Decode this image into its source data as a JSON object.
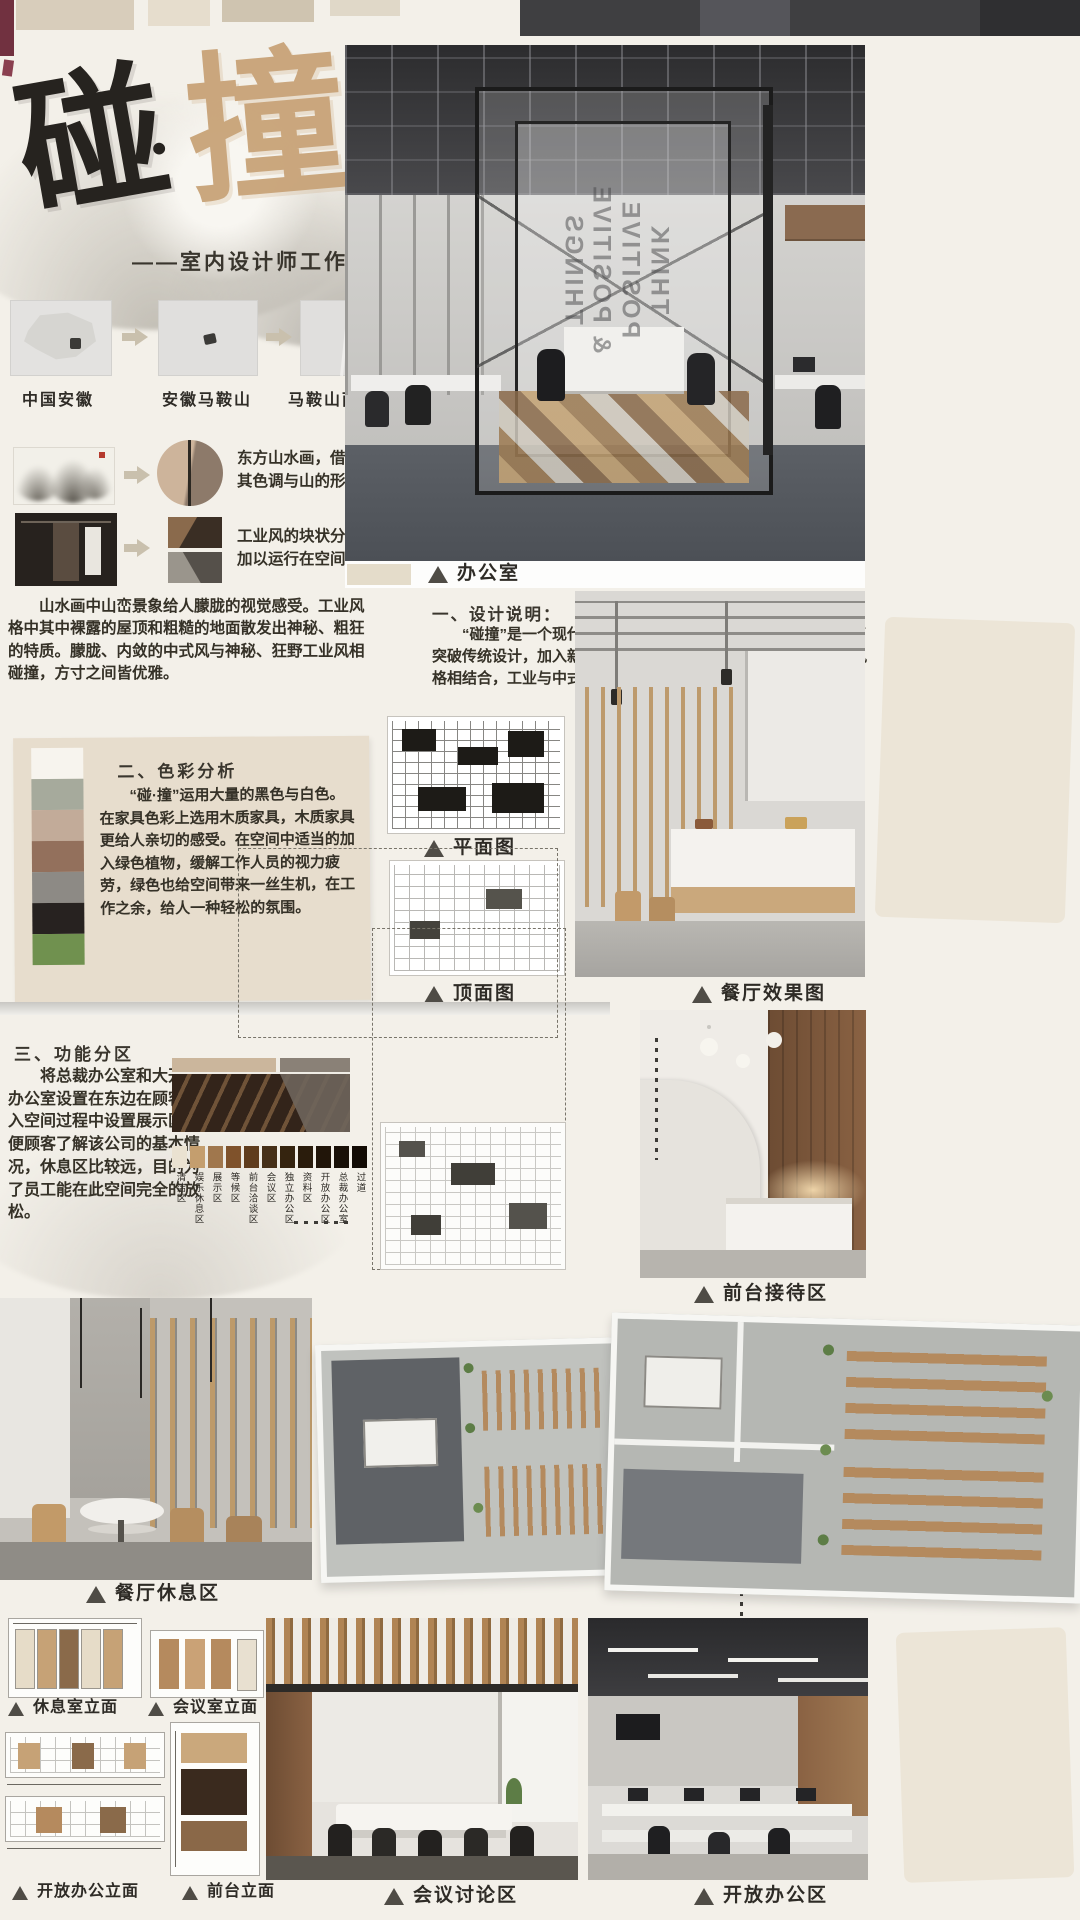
{
  "header": {
    "title_char_1": "碰",
    "title_dot": "·",
    "title_char_2": "撞",
    "subtitle": "——室内设计师工作室"
  },
  "location_flow": {
    "maps": [
      {
        "label": "中国安徽"
      },
      {
        "label": "安徽马鞍山"
      },
      {
        "label": "马鞍山雨山"
      }
    ]
  },
  "inspiration": {
    "row1_text": "东方山水画，借鉴其色调与山的形式",
    "row2_text": "工业风的块状分割加以运行在空间中",
    "summary": "山水画中山峦景象给人朦胧的视觉感受。工业风格中其中裸露的屋顶和粗糙的地面散发出神秘、粗狂的特质。朦胧、内敛的中式风与神秘、狂野工业风相碰撞，方寸之间皆优雅。"
  },
  "design_note": {
    "heading": "一、设计说明：",
    "body": "“碰撞”是一个现代办公空间，主要从事于室内设计行业。为了突破传统设计，加入新颖的设计元素，该设计将工业风与新中式风格相结合，工业与中式相碰撞，使空间更年轻化。"
  },
  "color_analysis": {
    "heading": "二、色彩分析",
    "body": "“碰·撞”运用大量的黑色与白色。在家具色彩上选用木质家具，木质家具更给人亲切的感受。在空间中适当的加入绿色植物，缓解工作人员的视力疲劳，绿色也给空间带来一丝生机，在工作之余，给人一种轻松的氛围。",
    "swatches": [
      "#f7f4ee",
      "#a6aa9c",
      "#c2ab99",
      "#93705c",
      "#8d8a85",
      "#272220",
      "#70914f"
    ]
  },
  "zoning": {
    "heading": "三、功能分区",
    "body": "将总裁办公室和大开放办公室设置在东边在顾客进入空间过程中设置展示区方便顾客了解该公司的基本情况，休息区比较远，目的为了员工能在此空间完全的放松。",
    "legend": [
      {
        "label": "清洁区",
        "color": "#eae2d1"
      },
      {
        "label": "娱乐休息区",
        "color": "#c49e6e"
      },
      {
        "label": "展示区",
        "color": "#a0774d"
      },
      {
        "label": "等候区",
        "color": "#7f522b"
      },
      {
        "label": "前台洽谈区",
        "color": "#5f3c1d"
      },
      {
        "label": "会议区",
        "color": "#463018"
      },
      {
        "label": "独立办公区",
        "color": "#35240f"
      },
      {
        "label": "资料区",
        "color": "#2a1c0c"
      },
      {
        "label": "开放办公区",
        "color": "#211509"
      },
      {
        "label": "总裁办公室",
        "color": "#191007"
      },
      {
        "label": "过道",
        "color": "#120b04"
      }
    ]
  },
  "office_render": {
    "glass_text_lines": [
      "THINK",
      "POSITIVE",
      "& POSITIVE",
      "THINGS"
    ]
  },
  "captions": {
    "office": "办公室",
    "plan": "平面图",
    "ceiling": "顶面图",
    "dining": "餐厅效果图",
    "reception": "前台接待区",
    "dining_lounge": "餐厅休息区",
    "lounge_elev": "休息室立面",
    "meeting_elev": "会议室立面",
    "open_elev": "开放办公立面",
    "front_elev": "前台立面",
    "meeting_zone": "会议讨论区",
    "open_zone": "开放办公区"
  }
}
